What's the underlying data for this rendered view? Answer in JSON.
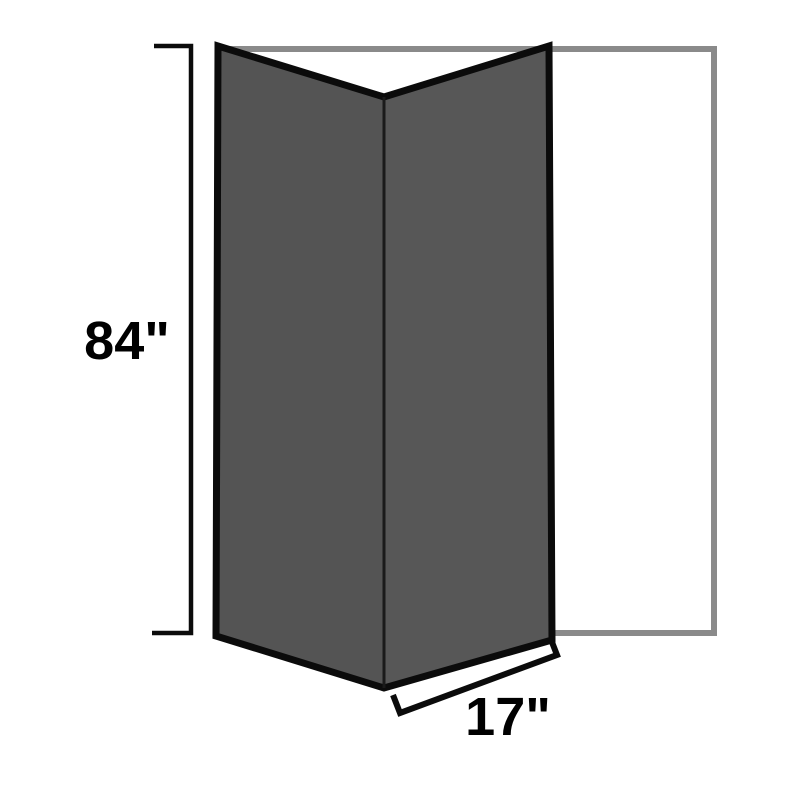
{
  "diagram": {
    "dimensions": {
      "height": {
        "label": "84\"",
        "value": 84,
        "unit": "inches"
      },
      "width": {
        "label": "17\"",
        "value": 17,
        "unit": "inches"
      }
    },
    "colors": {
      "background": "#ffffff",
      "panel_left_fill": "#545454",
      "panel_right_fill": "#575757",
      "panel_outline": "#0b0b0b",
      "crease": "#1a1a1a",
      "wall_outline": "#8a8a8a",
      "dimension_line": "#0b0b0b",
      "label_text": "#000000"
    }
  }
}
